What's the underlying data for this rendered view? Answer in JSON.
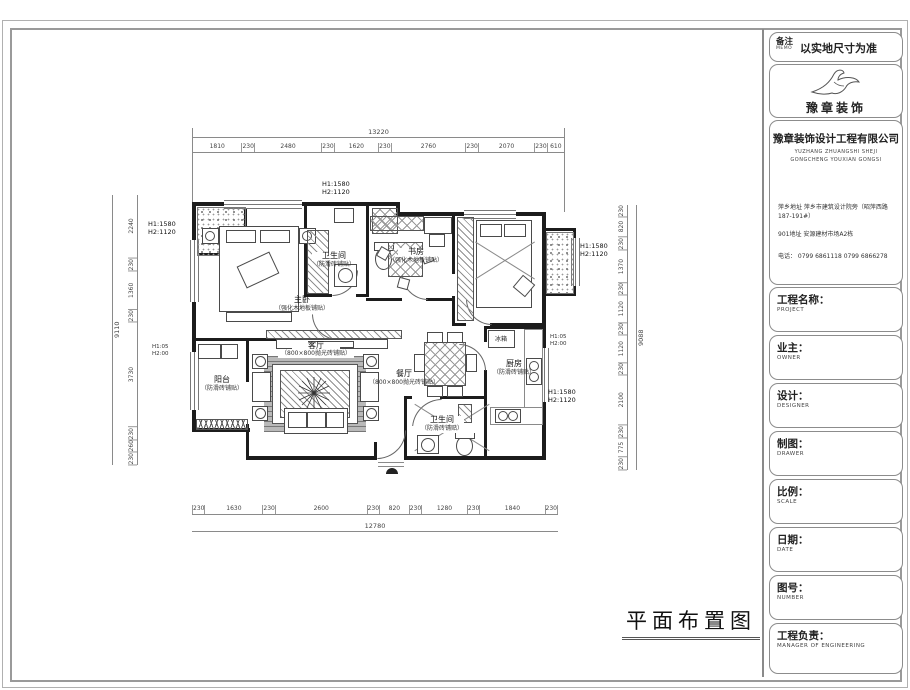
{
  "title_block": {
    "memo": {
      "label": "备注",
      "sub": "MEMO",
      "value": "以实地尺寸为准"
    },
    "logo": {
      "brand": "豫章装饰"
    },
    "company": {
      "name": "豫章装饰设计工程有限公司",
      "en1": "YUZHANG ZHUANGSHI SHEJI",
      "en2": "GONGCHENG YOUXIAN GONGSI",
      "addr1": "萍乡地址 萍乡市建筑设计院旁（昭萍西路187-191#）",
      "addr2": "901地址  安源建材市场A2栋",
      "phone": "电话：   0799 6861118   0799 6866278"
    },
    "fields": [
      {
        "label": "工程名称：",
        "sub": "PROJECT"
      },
      {
        "label": "业主：",
        "sub": "OWNER"
      },
      {
        "label": "设计：",
        "sub": "DESIGNER"
      },
      {
        "label": "制图：",
        "sub": "DRAWER"
      },
      {
        "label": "比例：",
        "sub": "SCALE"
      },
      {
        "label": "日期：",
        "sub": "DATE"
      },
      {
        "label": "图号：",
        "sub": "NUMBER"
      },
      {
        "label": "工程负责：",
        "sub": "MANAGER OF ENGINEERING"
      }
    ]
  },
  "plan": {
    "title": "平面布置图",
    "rooms": [
      {
        "name": "主卧",
        "finish": "（强化木地板铺贴）"
      },
      {
        "name": "卫生间",
        "finish": "（防滑砖铺贴）"
      },
      {
        "name": "书房",
        "finish": "（强化木地板铺贴）"
      },
      {
        "name": "客厅",
        "finish": "（800×800抛光砖铺贴）"
      },
      {
        "name": "餐厅",
        "finish": "（800×800抛光砖铺贴）"
      },
      {
        "name": "厨房",
        "finish": "（防滑砖铺贴）"
      },
      {
        "name": "阳台",
        "finish": "（防滑砖铺贴）"
      },
      {
        "name": "卫生间",
        "finish": "（防滑砖铺贴）"
      }
    ],
    "fridge_label": "冰箱",
    "window_note": {
      "h1": "H1:1580",
      "h2": "H2:1120"
    },
    "small_note": {
      "h1": "H1:05",
      "h2": "H2:00"
    }
  },
  "dims": {
    "top_total": "13220",
    "top_segments": [
      "1810",
      "230",
      "2480",
      "230",
      "1620",
      "230",
      "2760",
      "230",
      "2070",
      "230",
      "610"
    ],
    "bottom_total": "12780",
    "bottom_segments": [
      "230",
      "1630",
      "230",
      "2600",
      "230",
      "820",
      "230",
      "1280",
      "230",
      "1840",
      "230"
    ],
    "left_total": "9110",
    "left_segments": [
      "2240",
      "230",
      "1360",
      "230",
      "3730",
      "230",
      "260",
      "230"
    ],
    "right_total": "9088",
    "right_segments": [
      "230",
      "820",
      "230",
      "1370",
      "230",
      "1120",
      "230",
      "1120",
      "230",
      "2100",
      "230",
      "775",
      "230"
    ]
  }
}
